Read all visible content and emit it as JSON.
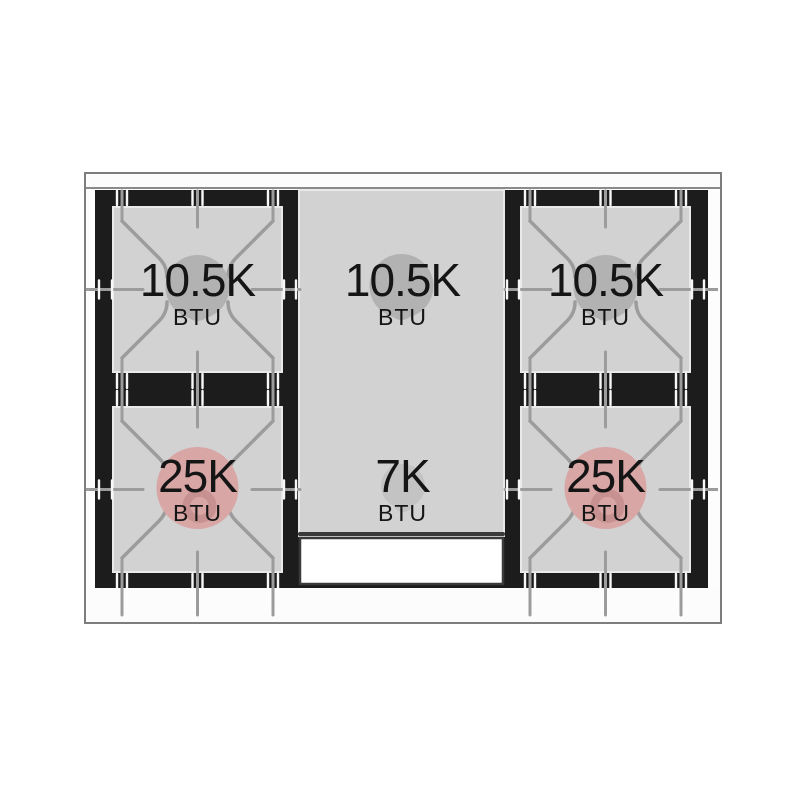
{
  "diagram": {
    "title": "Gas cooktop burner BTU layout",
    "unit": "BTU",
    "burners": [
      {
        "id": "back-left",
        "power": "10.5K",
        "unit": "BTU",
        "row": "back",
        "col": "left",
        "style": "grate",
        "accent": "#b2b2b2"
      },
      {
        "id": "back-center",
        "power": "10.5K",
        "unit": "BTU",
        "row": "back",
        "col": "center",
        "style": "griddle",
        "accent": "#b2b2b2"
      },
      {
        "id": "back-right",
        "power": "10.5K",
        "unit": "BTU",
        "row": "back",
        "col": "right",
        "style": "grate",
        "accent": "#b2b2b2"
      },
      {
        "id": "front-left",
        "power": "25K",
        "unit": "BTU",
        "row": "front",
        "col": "left",
        "style": "grate",
        "accent": "#d9a6a6"
      },
      {
        "id": "front-center",
        "power": "7K",
        "unit": "BTU",
        "row": "front",
        "col": "center",
        "style": "griddle",
        "accent": "#c3c3c3"
      },
      {
        "id": "front-right",
        "power": "25K",
        "unit": "BTU",
        "row": "front",
        "col": "right",
        "style": "grate",
        "accent": "#d9a6a6"
      }
    ],
    "colors": {
      "background": "#ffffff",
      "cooktop_black": "#1c1c1c",
      "surface_gray": "#d2d2d2",
      "grate_line": "#9c9c9c",
      "tick_white": "#f7f7f7",
      "frame_outline": "#7d7d7d",
      "dark_border": "#3a3a3a",
      "square_outline": "#e9e9e9",
      "pink_ring": "#c89191",
      "vent_white": "#ffffff",
      "text": "#151515"
    }
  }
}
